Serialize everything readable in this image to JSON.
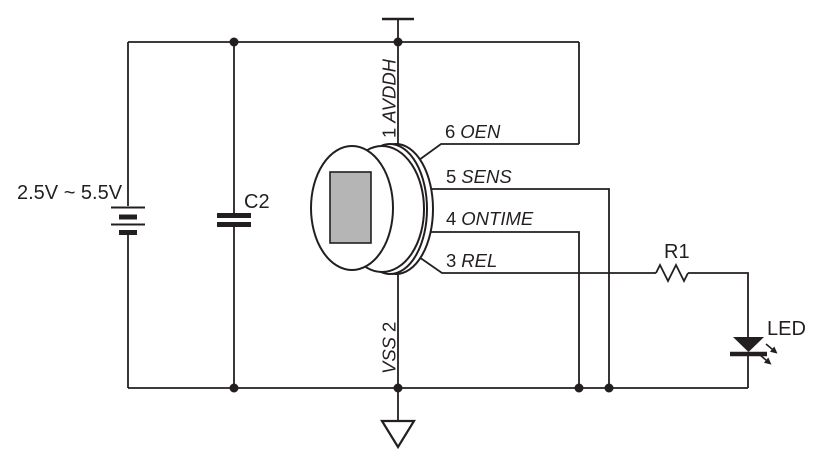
{
  "circuit": {
    "power": {
      "supply_label": "2.5V ~ 5.5V"
    },
    "components": {
      "capacitor": {
        "label": "C2"
      },
      "resistor": {
        "label": "R1"
      },
      "led": {
        "label": "LED"
      }
    },
    "sensor_pins": {
      "avddh": {
        "number": "1",
        "name": "AVDDH"
      },
      "vss": {
        "name": "VSS",
        "number": "2"
      },
      "rel": {
        "number": "3",
        "name": "REL"
      },
      "ontime": {
        "number": "4",
        "name": "ONTIME"
      },
      "sens": {
        "number": "5",
        "name": "SENS"
      },
      "oen": {
        "number": "6",
        "name": "OEN"
      }
    },
    "symbols": {
      "battery": "battery-2-cell-icon",
      "capacitor": "capacitor-plates-icon",
      "sensor": "pir-sensor-can-icon",
      "resistor": "resistor-zigzag-icon",
      "led": "led-diode-emitting-icon",
      "ground": "ground-triangle-icon",
      "supply": "supply-terminal-bar-icon"
    },
    "colors": {
      "line": "#231f20",
      "sensor_window": "#b5b5b5",
      "background": "#ffffff"
    }
  }
}
